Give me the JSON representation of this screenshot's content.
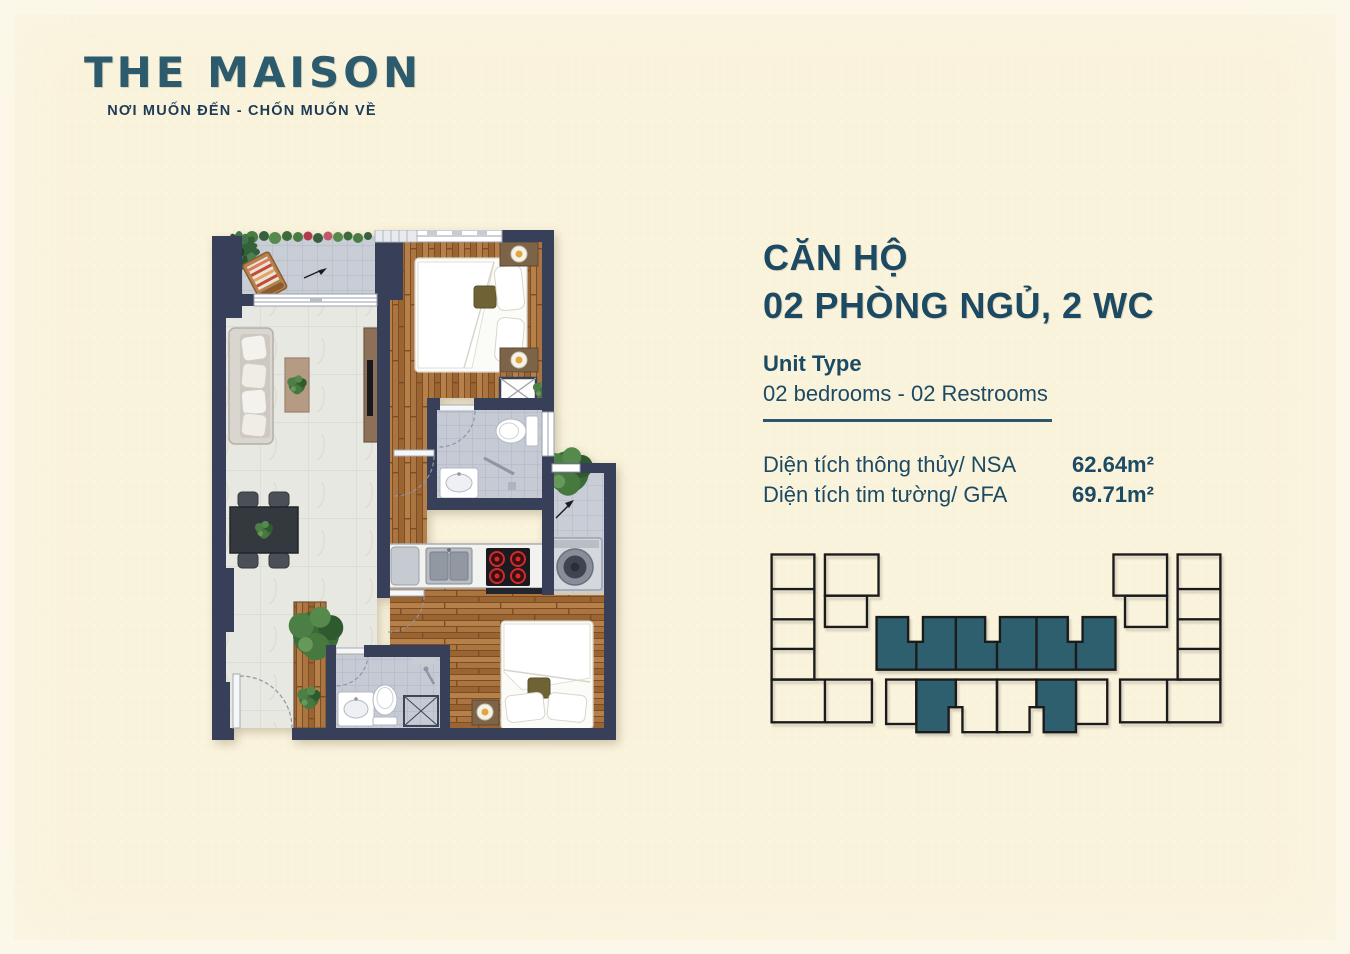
{
  "brand": {
    "logo": "THE MAISON",
    "tagline": "NƠI MUỐN ĐẾN - CHỐN MUỐN VỀ"
  },
  "unit": {
    "title_line1": "CĂN HỘ",
    "title_line2": "02 PHÒNG NGỦ, 2 WC",
    "type_label": "Unit Type",
    "type_value": "02 bedrooms - 02 Restrooms",
    "areas": [
      {
        "label": "Diện tích thông thủy/ NSA",
        "value": "62.64m²"
      },
      {
        "label": "Diện tích tim tường/ GFA",
        "value": "69.71m²"
      }
    ]
  },
  "colors": {
    "accent_teal": "#2b5b6c",
    "text_navy": "#1d4a63",
    "keyplan_highlight": "#2d5f6e",
    "background_cream": "#faf3dc",
    "plan_wall": "#374058"
  }
}
